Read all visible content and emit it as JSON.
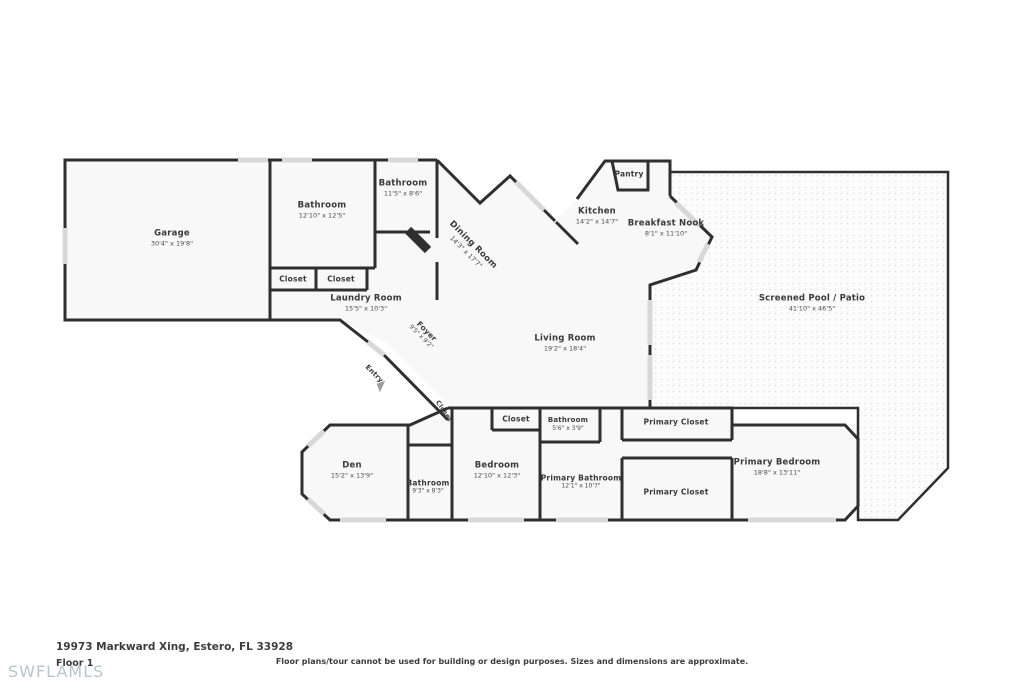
{
  "colors": {
    "wall": "#2f2f2f",
    "floor": "#f8f8f8",
    "window": "#d8d8d8",
    "watermark": "#b9c5cd"
  },
  "rooms": {
    "garage": {
      "name": "Garage",
      "dims": "30'4\" x 19'8\""
    },
    "bathroom_top": {
      "name": "Bathroom",
      "dims": "12'10\" x 12'5\""
    },
    "bathroom_upper": {
      "name": "Bathroom",
      "dims": "11'5\" x 8'6\""
    },
    "closet_a": {
      "name": "Closet"
    },
    "closet_b": {
      "name": "Closet"
    },
    "laundry": {
      "name": "Laundry Room",
      "dims": "15'5\" x 10'3\""
    },
    "dining": {
      "name": "Dining Room",
      "dims": "14'3\" x 17'7\""
    },
    "pantry": {
      "name": "Pantry"
    },
    "kitchen": {
      "name": "Kitchen",
      "dims": "14'2\" x 14'7\""
    },
    "breakfast_nook": {
      "name": "Breakfast Nook",
      "dims": "8'1\" x 11'10\""
    },
    "pool": {
      "name": "Screened Pool / Patio",
      "dims": "41'10\" x 46'5\""
    },
    "living": {
      "name": "Living Room",
      "dims": "19'2\" x 18'4\""
    },
    "foyer": {
      "name": "Foyer",
      "dims": "9'5\" x 9'2\""
    },
    "entry": {
      "name": "Entry"
    },
    "closet_hall": {
      "name": "Closet"
    },
    "closet_bedroom": {
      "name": "Closet"
    },
    "den": {
      "name": "Den",
      "dims": "15'2\" x 13'9\""
    },
    "bathroom_den": {
      "name": "Bathroom",
      "dims": "9'3\" x 8'3\""
    },
    "bedroom": {
      "name": "Bedroom",
      "dims": "12'10\" x 12'3\""
    },
    "bathroom_small": {
      "name": "Bathroom",
      "dims": "5'6\" x 3'9\""
    },
    "primary_bathroom": {
      "name": "Primary Bathroom",
      "dims": "12'1\" x 10'7\""
    },
    "primary_closet_top": {
      "name": "Primary Closet"
    },
    "primary_closet_bottom": {
      "name": "Primary Closet"
    },
    "primary_bedroom": {
      "name": "Primary Bedroom",
      "dims": "18'8\" x 13'11\""
    }
  },
  "footer": {
    "address": "19973 Markward Xing, Estero, FL 33928",
    "floor_label": "Floor 1",
    "watermark": "SWFLAMLS",
    "disclaimer": "Floor plans/tour cannot be used for building or design purposes. Sizes and dimensions are approximate."
  }
}
